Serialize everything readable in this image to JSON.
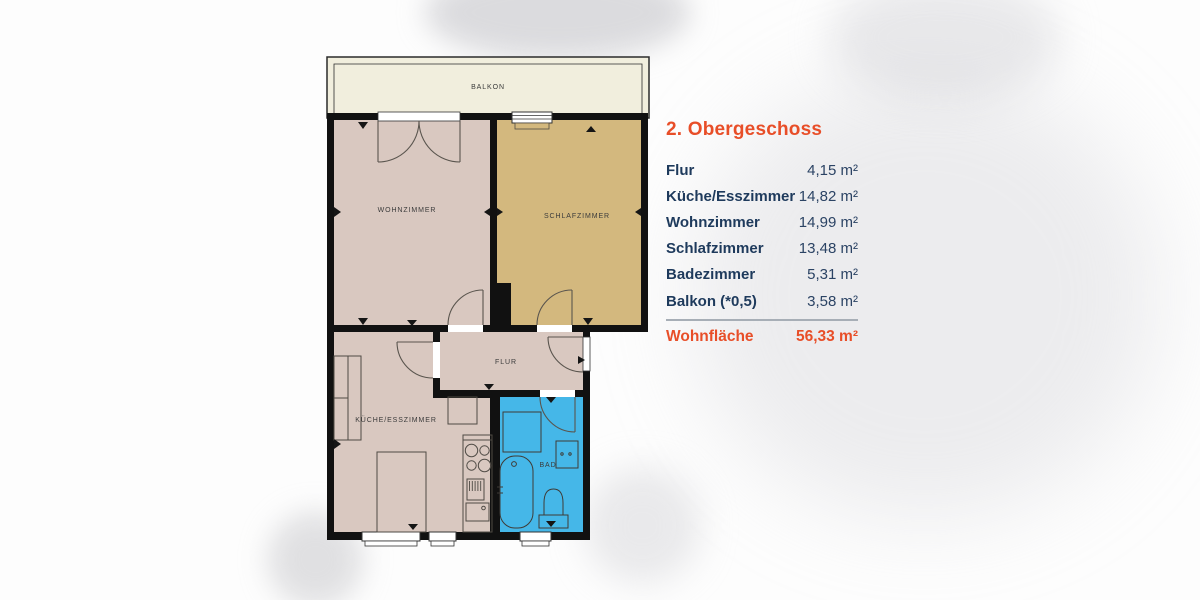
{
  "legend": {
    "title": "2. Obergeschoss",
    "rows": [
      {
        "label": "Flur",
        "value": "4,15 m²"
      },
      {
        "label": "Küche/Esszimmer",
        "value": "14,82 m²"
      },
      {
        "label": "Wohnzimmer",
        "value": "14,99 m²"
      },
      {
        "label": "Schlafzimmer",
        "value": "13,48 m²"
      },
      {
        "label": "Badezimmer",
        "value": "5,31 m²"
      },
      {
        "label": "Balkon (*0,5)",
        "value": "3,58 m²"
      }
    ],
    "total": {
      "label": "Wohnfläche",
      "value": "56,33 m²"
    }
  },
  "plan": {
    "rooms": {
      "balkon": {
        "label": "BALKON"
      },
      "wohnzimmer": {
        "label": "WOHNZIMMER"
      },
      "schlafzimmer": {
        "label": "SCHLAFZIMMER"
      },
      "flur": {
        "label": "FLUR"
      },
      "kueche": {
        "label": "KÜCHE/ESSZIMMER"
      },
      "bad": {
        "label": "BAD"
      }
    },
    "colors": {
      "wall": "#111111",
      "room_pink": "#d9c8c0",
      "schlafzimmer_tan": "#d3b87e",
      "bad_blue": "#45b7e8",
      "balkon_cream": "#f1eedd"
    }
  },
  "theme": {
    "accent_orange": "#e84e28",
    "navy": "#1e3a5c",
    "divider_gray": "#a7aeb6"
  }
}
